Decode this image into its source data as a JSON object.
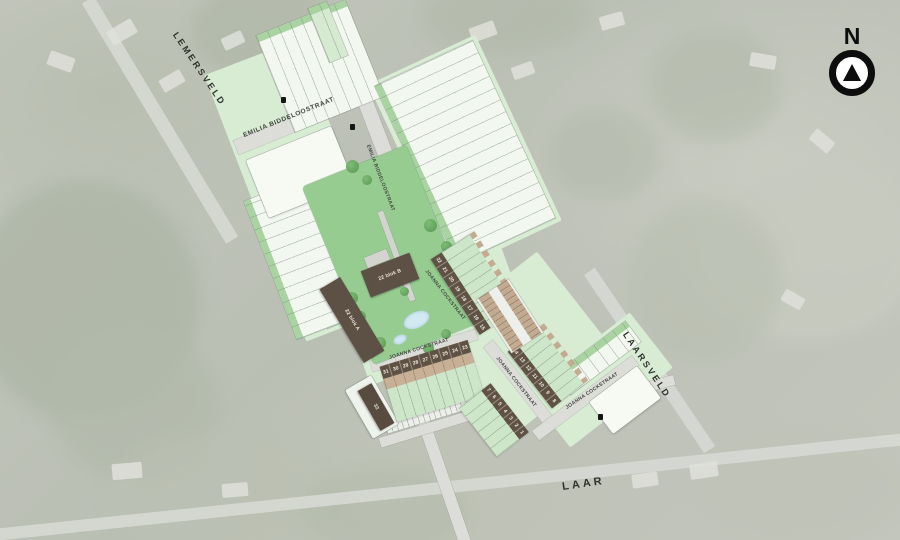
{
  "compass": {
    "label": "N"
  },
  "streets": {
    "lemersveld": "LEMERSVELD",
    "emilia_top": "EMILIA BIDDELOOSTRAAT",
    "emilia_side": "EMILIA BIDDELOOSTRAAT",
    "joanna_upper": "JOANNA COCKSTRAAT",
    "joanna_mid": "JOANNA COCKSTRAAT",
    "joanna_lower": "JOANNA COCKSTRAAT",
    "joanna_east": "JOANNA COCKSTRAAT",
    "laarsveld": "LAARSVELD",
    "laar": "LAAR"
  },
  "buildings": {
    "blok_a": "22 blok A",
    "blok_b": "22 blok B",
    "lot32": "32"
  },
  "lots": {
    "row_south": [
      "31",
      "30",
      "29",
      "28",
      "27",
      "26",
      "25",
      "24",
      "23"
    ],
    "row_mid": [
      "22",
      "21",
      "20",
      "19",
      "18",
      "17",
      "16",
      "15"
    ],
    "row_east_upper": [
      "14",
      "13",
      "12",
      "11",
      "10",
      "9",
      "8"
    ],
    "row_east_lower": [
      "7",
      "6",
      "5",
      "4",
      "3",
      "2",
      "1"
    ]
  },
  "colors": {
    "park_green": "#97cc91",
    "lot_green": "#d8ecd4",
    "building_brown": "#5f5245",
    "garage_tan": "#c7b096",
    "road_gray": "#dcddd8",
    "pond_blue": "#d2e9f2",
    "compass_black": "#0d0d0d"
  }
}
